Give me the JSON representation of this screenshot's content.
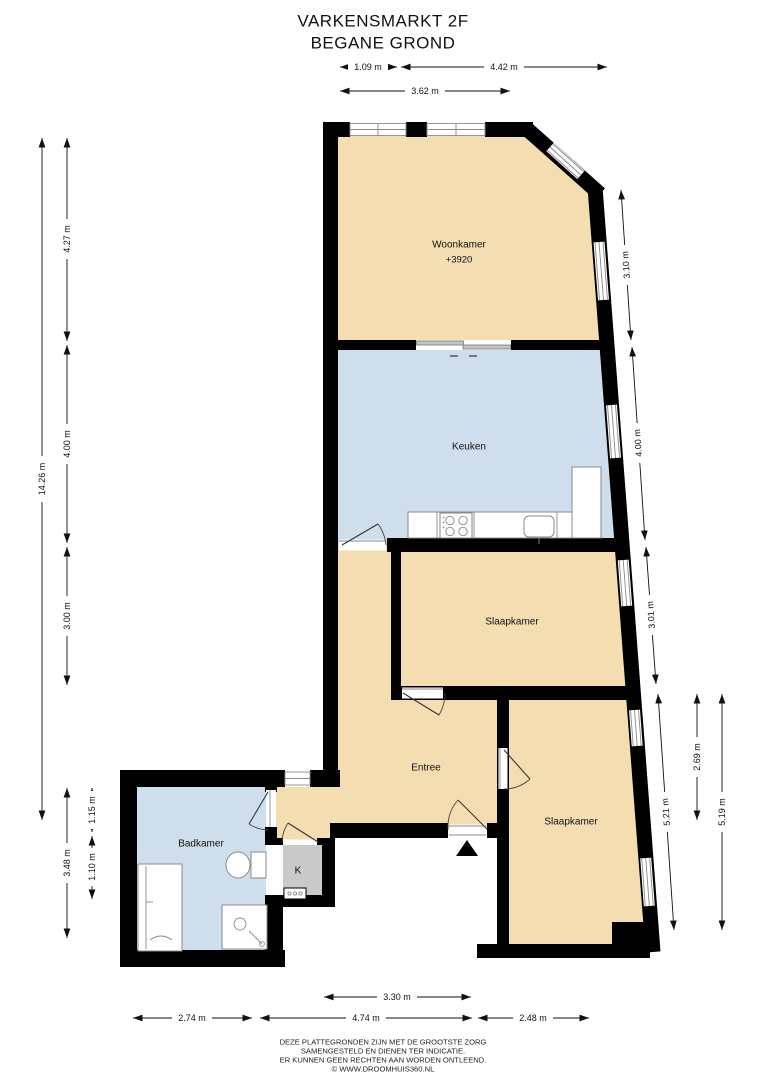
{
  "title": {
    "line1": "VARKENSMARKT 2F",
    "line2": "BEGANE GROND"
  },
  "rooms": {
    "woonkamer": {
      "label": "Woonkamer",
      "sublabel": "+3920"
    },
    "keuken": {
      "label": "Keuken"
    },
    "slaapkamer_mid": {
      "label": "Slaapkamer"
    },
    "slaapkamer_lower": {
      "label": "Slaapkamer"
    },
    "entree": {
      "label": "Entree"
    },
    "badkamer": {
      "label": "Badkamer"
    },
    "kast": {
      "label": "K"
    }
  },
  "dimensions": {
    "top": [
      "1.09 m",
      "4.42 m",
      "3.62 m"
    ],
    "left": [
      "14.26 m",
      "4.27 m",
      "4.00 m",
      "3.00 m",
      "3.48 m",
      "1.15 m",
      "1.10 m"
    ],
    "right": [
      "3.10 m",
      "4.00 m",
      "3.01 m",
      "5.21 m",
      "2.69 m",
      "5.19 m"
    ],
    "bottom": [
      "3.30 m",
      "2.74 m",
      "4.74 m",
      "2.48 m"
    ]
  },
  "footer": {
    "lines": [
      "DEZE PLATTEGRONDEN ZIJN MET DE GROOTSTE ZORG",
      "SAMENGESTELD EN DIENEN TER INDICATIE.",
      "ER KUNNEN GEEN RECHTEN AAN WORDEN ONTLEEND.",
      "© WWW.DROOMHUIS360.NL"
    ]
  },
  "colors": {
    "room_tan": "#F3DDB1",
    "room_blue": "#CFDEEC",
    "closet_gray": "#CACACA",
    "wall": "#000000"
  }
}
